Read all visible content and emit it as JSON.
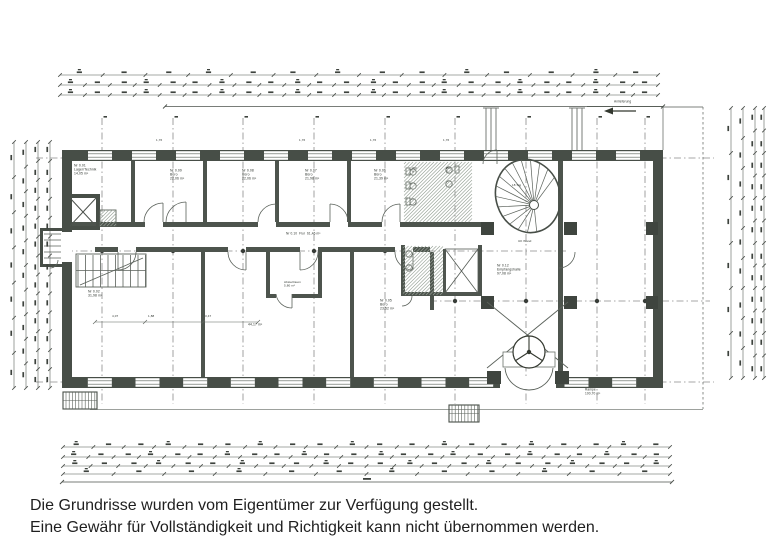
{
  "disclaimer": {
    "line1": "Die Grundrisse wurden vom Eigentümer zur Verfügung gestellt.",
    "line2": "Eine Gewähr für Vollständigkeit und Richtigkeit kann nicht übernommen werden."
  },
  "colors": {
    "wall": "#474e47",
    "line": "#5a615a",
    "thin": "#757b75",
    "hatch": "#97a297",
    "axis": "#8a8a8a",
    "dim": "#4d524d",
    "smudge": "#3d423d",
    "dot": "#383d38"
  },
  "plan": {
    "labels": [
      {
        "x": 74,
        "y": 164,
        "s": 3.4,
        "t": "Nr 0.01\nLager/Technik\n14,05 m²"
      },
      {
        "x": 170,
        "y": 169,
        "s": 3.4,
        "t": "Nr 0.09\nBüro\n22,06 m²"
      },
      {
        "x": 242,
        "y": 169,
        "s": 3.4,
        "t": "Nr 0.08\nBüro\n22,06 m²"
      },
      {
        "x": 305,
        "y": 169,
        "s": 3.4,
        "t": "Nr 0.07\nBüro\n21,98 m²"
      },
      {
        "x": 374,
        "y": 169,
        "s": 3.4,
        "t": "Nr 0.06\nBüro\n21,39 m²"
      },
      {
        "x": 412,
        "y": 167,
        "s": 3,
        "t": "WC\nH"
      },
      {
        "x": 446,
        "y": 167,
        "s": 3,
        "t": "WC\nD"
      },
      {
        "x": 286,
        "y": 232,
        "s": 3.2,
        "t": "Nr 0.10  Flur  61,46 m²"
      },
      {
        "x": 88,
        "y": 290,
        "s": 3.4,
        "t": "Nr 0.02\n31,98 m²"
      },
      {
        "x": 284,
        "y": 281,
        "s": 3,
        "t": "Abstellraum\n5,80 m²"
      },
      {
        "x": 380,
        "y": 299,
        "s": 3.4,
        "t": "Nr 0.05\nBüro\n23,52 m²"
      },
      {
        "x": 248,
        "y": 323,
        "s": 3.4,
        "t": "44,17 m²"
      },
      {
        "x": 497,
        "y": 264,
        "s": 3.4,
        "t": "Nr 0.12\nEmpfangshalle\n97,08 m²"
      },
      {
        "x": 512,
        "y": 184,
        "s": 3,
        "t": "18 Stg"
      },
      {
        "x": 585,
        "y": 388,
        "s": 3.2,
        "t": "Rampe\n100,70 m²"
      },
      {
        "x": 614,
        "y": 100,
        "s": 3.2,
        "t": "Anlieferung"
      },
      {
        "x": 518,
        "y": 240,
        "s": 3,
        "t": "UK Wand"
      },
      {
        "x": 156,
        "y": 139,
        "s": 3,
        "t": "1,76"
      },
      {
        "x": 299,
        "y": 139,
        "s": 3,
        "t": "1,76"
      },
      {
        "x": 370,
        "y": 139,
        "s": 3,
        "t": "1,76"
      },
      {
        "x": 443,
        "y": 139,
        "s": 3,
        "t": "1,76"
      },
      {
        "x": 112,
        "y": 315,
        "s": 3,
        "t": "4,07"
      },
      {
        "x": 148,
        "y": 315,
        "s": 3,
        "t": "1,88"
      },
      {
        "x": 205,
        "y": 315,
        "s": 3,
        "t": "3,47"
      }
    ],
    "axes": {
      "vertical_x": [
        102,
        173,
        243,
        314,
        385,
        455,
        526,
        597,
        645
      ],
      "v_y0": 118,
      "v_y1": 404,
      "horizontal": [
        {
          "y": 158,
          "x0": 36,
          "x1": 714
        },
        {
          "y": 251,
          "x0": 66,
          "x1": 566
        },
        {
          "y": 301,
          "x0": 430,
          "x1": 710
        },
        {
          "y": 382,
          "x0": 36,
          "x1": 714
        }
      ],
      "dot_rows": [
        158,
        382
      ],
      "extra_dots": [
        [
          455,
          301
        ],
        [
          526,
          301
        ],
        [
          597,
          301
        ],
        [
          645,
          301
        ],
        [
          102,
          251
        ],
        [
          173,
          251
        ],
        [
          243,
          251
        ],
        [
          314,
          251
        ],
        [
          385,
          251
        ]
      ]
    },
    "windows": {
      "top": {
        "wy": 150,
        "wh": 11,
        "count": 13,
        "x0": 78,
        "x1": 650
      },
      "bottom": {
        "wy": 377,
        "wh": 11,
        "count": 12,
        "x0": 76,
        "x1": 648,
        "skip_x0": 488,
        "skip_x1": 568
      }
    },
    "dims": {
      "top": {
        "x0": 60,
        "x1": 658,
        "rows": [
          {
            "y": 75,
            "n": 14
          },
          {
            "y": 85,
            "n": 24
          },
          {
            "y": 95,
            "n": 24
          }
        ],
        "underline": {
          "y": 106.5,
          "x0": 165,
          "x1": 663
        }
      },
      "bottom": {
        "x0": 63,
        "x1": 670,
        "rows": [
          {
            "y": 447,
            "n": 20
          },
          {
            "y": 457,
            "n": 24
          },
          {
            "y": 466,
            "n": 22
          },
          {
            "y": 474,
            "n": 12
          }
        ],
        "baseline": {
          "y": 482,
          "x0": 62,
          "x1": 672
        }
      },
      "left": {
        "y0": 142,
        "y1": 388,
        "cols": [
          {
            "x": 14,
            "n": 7
          },
          {
            "x": 26,
            "n": 10
          },
          {
            "x": 38,
            "n": 13
          },
          {
            "x": 50,
            "n": 13
          }
        ]
      },
      "right": {
        "y0": 108,
        "y1": 378,
        "cols": [
          {
            "x": 731,
            "n": 6
          },
          {
            "x": 743,
            "n": 9
          },
          {
            "x": 755,
            "n": 12
          },
          {
            "x": 764,
            "n": 12
          }
        ]
      }
    },
    "spiral": {
      "cx": 528,
      "cy": 196,
      "rx": 32,
      "ry": 37,
      "rot": -18,
      "treads": 15,
      "a0": 95,
      "a1": 345,
      "hub_r": 4.5
    },
    "hatches": [
      {
        "x": 404,
        "y": 162,
        "w": 68,
        "h": 60
      },
      {
        "x": 403,
        "y": 246,
        "w": 40,
        "h": 49
      },
      {
        "x": 100,
        "y": 210,
        "w": 16,
        "h": 16
      }
    ],
    "ext_stairs": [
      {
        "x": 63,
        "y": 392,
        "w": 34,
        "h": 17
      },
      {
        "x": 449,
        "y": 405,
        "w": 30,
        "h": 17
      }
    ],
    "stair_left": {
      "x0": 78,
      "x1": 146,
      "y0": 255,
      "y1": 287,
      "step": 7.5
    }
  }
}
